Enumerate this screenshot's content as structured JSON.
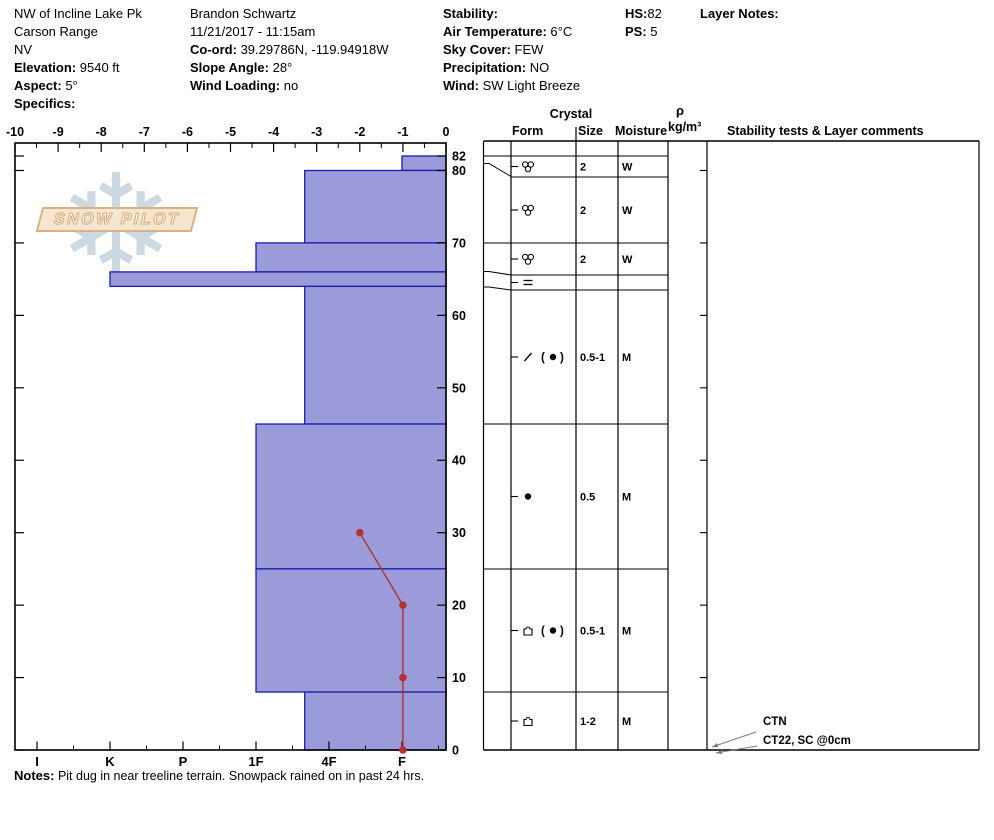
{
  "header": {
    "col1": {
      "lines": [
        "NW of Incline Lake Pk",
        "Carson Range",
        "NV"
      ],
      "fields": [
        {
          "label": "Elevation:",
          "value": "9540 ft"
        },
        {
          "label": "Aspect:",
          "value": "5°"
        },
        {
          "label": "Specifics:",
          "value": ""
        }
      ]
    },
    "col2": {
      "lines": [
        "Brandon Schwartz",
        "11/21/2017 - 11:15am"
      ],
      "fields": [
        {
          "label": "Co-ord:",
          "value": "39.29786N, -119.94918W"
        },
        {
          "label": "Slope Angle:",
          "value": "28°"
        },
        {
          "label": "Wind Loading:",
          "value": "no"
        }
      ]
    },
    "col3": {
      "fields": [
        {
          "label": "Stability:",
          "value": ""
        },
        {
          "label": "Air Temperature:",
          "value": "6°C"
        },
        {
          "label": "Sky Cover:",
          "value": "FEW"
        },
        {
          "label": "Precipitation:",
          "value": "NO"
        },
        {
          "label": "Wind:",
          "value": "SW Light Breeze"
        }
      ]
    },
    "col4": {
      "fields": [
        {
          "label": "HS:",
          "value": "82"
        },
        {
          "label": "PS:",
          "value": "5"
        }
      ]
    },
    "col5": {
      "fields": [
        {
          "label": "Layer Notes:",
          "value": ""
        }
      ]
    }
  },
  "watermark": {
    "brand": "SNOW PILOT",
    "flake_glyph": "❄"
  },
  "chart_data": [
    {
      "type": "bar",
      "title": "Snow hardness profile (horizontal bars, right-to-left = softer to harder)",
      "xlabel": "Hand hardness",
      "ylabel": "Depth (cm)",
      "x_categories": [
        "I",
        "K",
        "P",
        "1F",
        "4F",
        "F"
      ],
      "ylim": [
        0,
        84
      ],
      "depth_ticks": [
        0,
        10,
        20,
        30,
        40,
        50,
        60,
        70,
        80,
        82
      ],
      "layers": [
        {
          "top": 82,
          "bottom": 80,
          "hardness": "F"
        },
        {
          "top": 80,
          "bottom": 70,
          "hardness": "4F-"
        },
        {
          "top": 70,
          "bottom": 66,
          "hardness": "1F"
        },
        {
          "top": 66,
          "bottom": 64,
          "hardness": "K"
        },
        {
          "top": 64,
          "bottom": 45,
          "hardness": "4F-"
        },
        {
          "top": 45,
          "bottom": 25,
          "hardness": "1F"
        },
        {
          "top": 25,
          "bottom": 8,
          "hardness": "1F"
        },
        {
          "top": 8,
          "bottom": 0,
          "hardness": "4F-"
        }
      ]
    },
    {
      "type": "line",
      "title": "Snow temperature profile",
      "xlabel": "Temperature (°C)",
      "xlim": [
        -10,
        0
      ],
      "x_tick_step": 1,
      "points": [
        {
          "depth": 30,
          "temp": -2
        },
        {
          "depth": 20,
          "temp": -1
        },
        {
          "depth": 10,
          "temp": -1
        },
        {
          "depth": 0,
          "temp": -1
        }
      ]
    }
  ],
  "table": {
    "headers": {
      "crystal": "Crystal",
      "form": "Form",
      "size": "Size",
      "moisture": "Moisture",
      "rho_symbol": "ρ",
      "rho_units": "kg/m³",
      "stability": "Stability tests & Layer comments"
    },
    "rows": [
      {
        "form_code": "MF",
        "form_primary": "cluster",
        "form_secondary": null,
        "size": "2",
        "moisture": "W"
      },
      {
        "form_code": "MF",
        "form_primary": "cluster",
        "form_secondary": null,
        "size": "2",
        "moisture": "W"
      },
      {
        "form_code": "MF",
        "form_primary": "cluster",
        "form_secondary": null,
        "size": "2",
        "moisture": "W"
      },
      {
        "form_code": "IF",
        "form_primary": "ice",
        "form_secondary": null,
        "size": "",
        "moisture": ""
      },
      {
        "form_code": "DF(RG)",
        "form_primary": "df",
        "form_secondary": "rg",
        "size": "0.5-1",
        "moisture": "M"
      },
      {
        "form_code": "RG",
        "form_primary": "rg",
        "form_secondary": null,
        "size": "0.5",
        "moisture": "M"
      },
      {
        "form_code": "FC(RG)",
        "form_primary": "fc",
        "form_secondary": "rg",
        "size": "0.5-1",
        "moisture": "M"
      },
      {
        "form_code": "FC",
        "form_primary": "fc",
        "form_secondary": null,
        "size": "1-2",
        "moisture": "M"
      }
    ],
    "row_bands_px": [
      [
        156,
        177
      ],
      [
        177,
        243
      ],
      [
        243,
        275
      ],
      [
        275,
        290
      ],
      [
        290,
        424
      ],
      [
        424,
        569
      ],
      [
        569,
        692
      ],
      [
        692,
        750
      ]
    ]
  },
  "stability_tests": [
    {
      "label": "CTN"
    },
    {
      "label": "CT22, SC @0cm"
    }
  ],
  "notes": {
    "label": "Notes:",
    "text": "Pit dug in near treeline terrain. Snowpack rained on in past 24 hrs."
  },
  "colors": {
    "bar_fill": "#9b9bd9",
    "bar_border": "#1c1caf",
    "temp_line": "#b23232",
    "line_black": "#000000",
    "arrow_gray": "#7d7d7d",
    "flake": "#ccd8e2",
    "band_fill": "#f7e6cf",
    "band_border": "#d9b185"
  }
}
